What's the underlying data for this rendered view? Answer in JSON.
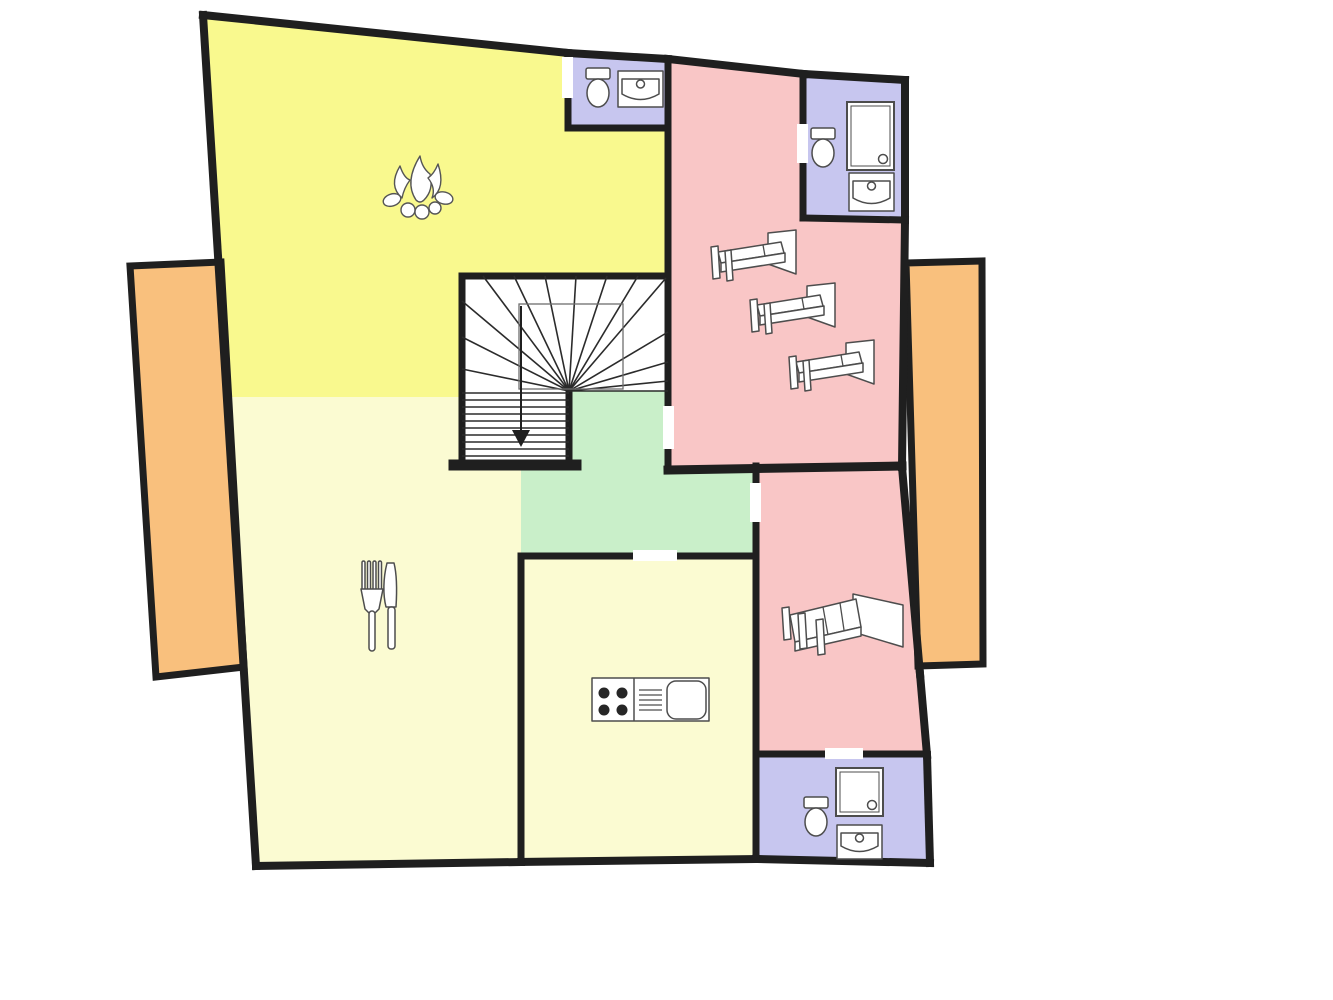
{
  "meta": {
    "type": "architectural-floor-plan",
    "floor": "upper-floor-with-stair-down",
    "background": "#ffffff"
  },
  "palette": {
    "wall": "#1f1f1f",
    "furniture_stroke": "#4d4d4d",
    "living": "#f9f98e",
    "pale": "#fbfbd2",
    "green": "#c9efc9",
    "pink": "#f9c6c6",
    "lavender": "#c7c6ef",
    "orange": "#f9c07d",
    "white": "#ffffff"
  },
  "rooms": [
    {
      "name": "living-room",
      "fill": "living",
      "points": "203,15 568,53 568,130 668,130 668,276 462,276 462,397 226,397"
    },
    {
      "name": "dining-room",
      "fill": "pale",
      "points": "226,397 462,397 462,466 521,466 521,863 256,866"
    },
    {
      "name": "kitchen",
      "fill": "pale",
      "points": "521,556 756,556 756,860 521,862"
    },
    {
      "name": "hallway",
      "fill": "green",
      "points": "569,391 668,391 668,470 756,470 756,556 521,556 521,466 569,466"
    },
    {
      "name": "stairwell",
      "fill": "white",
      "points": "462,276 668,276 668,391 569,391 569,466 462,466"
    },
    {
      "name": "bedroom-triple",
      "fill": "pink",
      "points": "668,59 905,80 902,467 668,467"
    },
    {
      "name": "bedroom-double",
      "fill": "pink",
      "points": "756,465 902,465 920,674 927,755 756,755"
    },
    {
      "name": "bathroom-top",
      "fill": "lavender",
      "points": "568,55 668,59 668,128 568,128"
    },
    {
      "name": "bathroom-right",
      "fill": "lavender",
      "points": "803,74 905,80 905,220 803,218"
    },
    {
      "name": "bathroom-bottom",
      "fill": "lavender",
      "points": "756,755 927,755 930,863 756,860"
    }
  ],
  "balconies": [
    {
      "name": "balcony-left",
      "points": "130,266 221,262 244,667 156,677"
    },
    {
      "name": "balcony-right",
      "points": "906,263 982,261 983,664 918,666"
    }
  ],
  "walls": [
    [
      203,
      15,
      568,
      53,
      8
    ],
    [
      568,
      53,
      668,
      59,
      8
    ],
    [
      668,
      59,
      804,
      74,
      8
    ],
    [
      804,
      74,
      905,
      80,
      8
    ],
    [
      905,
      80,
      905,
      220,
      8
    ],
    [
      905,
      220,
      902,
      467,
      8
    ],
    [
      902,
      467,
      920,
      674,
      8
    ],
    [
      920,
      674,
      927,
      755,
      8
    ],
    [
      927,
      755,
      930,
      863,
      8
    ],
    [
      930,
      863,
      756,
      859,
      8
    ],
    [
      756,
      859,
      521,
      862,
      8
    ],
    [
      521,
      862,
      256,
      866,
      8
    ],
    [
      256,
      866,
      203,
      15,
      8
    ],
    [
      568,
      53,
      568,
      128,
      7
    ],
    [
      568,
      128,
      668,
      128,
      7
    ],
    [
      668,
      59,
      668,
      470,
      7
    ],
    [
      803,
      74,
      803,
      218,
      7
    ],
    [
      803,
      218,
      905,
      220,
      7
    ],
    [
      462,
      276,
      668,
      276,
      7
    ],
    [
      462,
      276,
      462,
      465,
      7
    ],
    [
      454,
      465,
      576,
      465,
      11
    ],
    [
      569,
      389,
      569,
      465,
      7
    ],
    [
      668,
      470,
      902,
      466,
      9
    ],
    [
      756,
      466,
      756,
      859,
      7
    ],
    [
      521,
      556,
      756,
      556,
      7
    ],
    [
      521,
      556,
      521,
      862,
      7
    ],
    [
      756,
      754,
      927,
      754,
      7
    ]
  ],
  "door_gaps": [
    [
      562,
      57,
      11,
      41
    ],
    [
      797,
      124,
      11,
      39
    ],
    [
      663,
      406,
      11,
      43
    ],
    [
      750,
      483,
      11,
      39
    ],
    [
      633,
      550,
      44,
      11
    ],
    [
      825,
      748,
      38,
      11
    ]
  ],
  "stairs": {
    "center": [
      569,
      391
    ],
    "spokes": [
      [
        462,
        301
      ],
      [
        462,
        337
      ],
      [
        462,
        369
      ],
      [
        483,
        276
      ],
      [
        514,
        276
      ],
      [
        545,
        276
      ],
      [
        576,
        276
      ],
      [
        607,
        276
      ],
      [
        638,
        276
      ],
      [
        666,
        278
      ],
      [
        668,
        332
      ],
      [
        668,
        362
      ],
      [
        668,
        381
      ],
      [
        668,
        391
      ]
    ],
    "treads": {
      "x1": 462,
      "x2": 569,
      "ys": [
        393,
        400,
        407,
        414,
        421,
        428,
        435,
        442,
        449,
        456
      ]
    },
    "landing_rect": [
      519,
      304,
      104,
      85
    ],
    "arrow": {
      "x": 521,
      "y1": 306,
      "y2": 432,
      "head": "512,430 530,430 521,447"
    }
  },
  "furniture": [
    {
      "type": "toilet",
      "name": "toilet-bathroom-top",
      "x": 586,
      "y": 68
    },
    {
      "type": "sink",
      "name": "sink-bathroom-top",
      "x": 618,
      "y": 71,
      "w": 45,
      "h": 36
    },
    {
      "type": "toilet",
      "name": "toilet-bathroom-right",
      "x": 811,
      "y": 128
    },
    {
      "type": "shower",
      "name": "shower-bathroom-right",
      "x": 847,
      "y": 102,
      "w": 47,
      "h": 68
    },
    {
      "type": "sink",
      "name": "sink-bathroom-right",
      "x": 849,
      "y": 173,
      "w": 45,
      "h": 38
    },
    {
      "type": "toilet",
      "name": "toilet-bathroom-bottom",
      "x": 804,
      "y": 797
    },
    {
      "type": "shower",
      "name": "shower-bathroom-bottom",
      "x": 836,
      "y": 768,
      "w": 47,
      "h": 48
    },
    {
      "type": "sink",
      "name": "sink-bathroom-bottom",
      "x": 837,
      "y": 825,
      "w": 45,
      "h": 34
    },
    {
      "type": "stove",
      "name": "kitchen-stove-sink-unit",
      "x": 592,
      "y": 678
    },
    {
      "type": "single_bed",
      "name": "single-bed-1",
      "x": 705,
      "y": 228
    },
    {
      "type": "single_bed",
      "name": "single-bed-2",
      "x": 744,
      "y": 281
    },
    {
      "type": "single_bed",
      "name": "single-bed-3",
      "x": 783,
      "y": 338
    },
    {
      "type": "double_bed",
      "name": "double-bed",
      "x": 780,
      "y": 590
    },
    {
      "type": "campfire",
      "name": "fireplace-campfire",
      "x": 380,
      "y": 148
    },
    {
      "type": "cutlery",
      "name": "dining-fork-knife",
      "x": 360,
      "y": 561
    }
  ]
}
